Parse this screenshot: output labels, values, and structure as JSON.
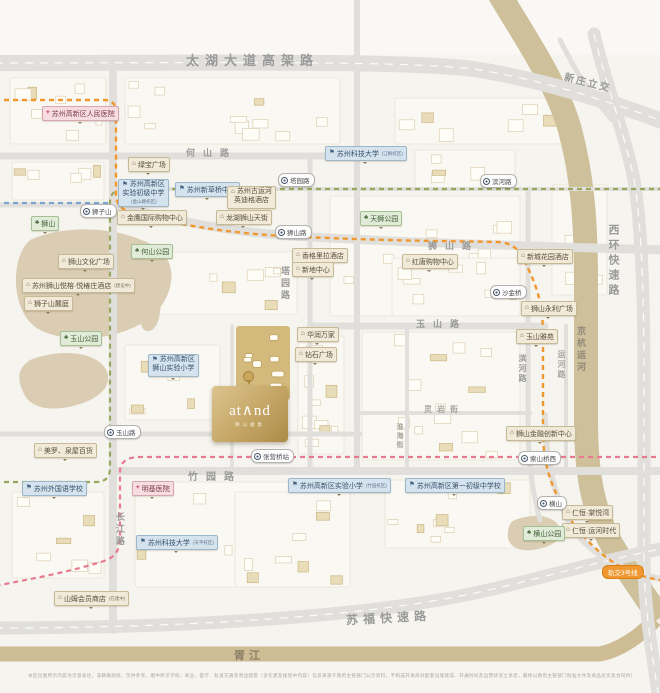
{
  "project": {
    "logo": "at∧nd",
    "subtitle": "狮山雅集"
  },
  "colors": {
    "gold": "#c9ab62",
    "canal": "#cfc09c",
    "metro_line_orange": "#f0982f",
    "metro_line_green": "#99a75d",
    "metro_line_pink": "#e8798f",
    "metro_line_blue": "#7ba3cf"
  },
  "icons": {
    "park": "♣",
    "hospital": "+",
    "school": "⚑",
    "shop": "⌂",
    "hotel": "⌂",
    "residence": "⌂"
  },
  "roads": {
    "taihu_viaduct": "太湖大道高架路",
    "xinzhuang": "新庄立交",
    "heshan": "何山路",
    "shishan": "狮山路",
    "yushan": "玉山路",
    "zhuyuan": "竹园路",
    "changjiang": "长江路",
    "tayuan": "塔园路",
    "huaihai": "淮海街",
    "binhe": "滨河路",
    "yunhe_rd": "运河路",
    "grand_canal": "京杭运河",
    "xihuan": "西环快速路",
    "sufu": "苏福快速路",
    "xujiang": "胥江",
    "lingyan": "灵岩街"
  },
  "stations": [
    "狮子山",
    "塔园路",
    "滨河路",
    "狮山路",
    "沙金桥",
    "玉山路",
    "张营桥站",
    "索山桥西",
    "横山"
  ],
  "metro_badge": "轨交3号线",
  "pois": [
    {
      "label": "苏州高新区人民医院",
      "type": "hospital"
    },
    {
      "label": "绿宝广场",
      "type": "shop"
    },
    {
      "label": "苏州高新区",
      "label2": "实验初级中学",
      "suffix": "(金山路校区)",
      "type": "school"
    },
    {
      "label": "苏州新草桥中学",
      "type": "school"
    },
    {
      "label": "苏州古运河",
      "label2": "英迪格酒店",
      "type": "hotel"
    },
    {
      "label": "苏州科技大学",
      "suffix": "(江枫校区)",
      "type": "school"
    },
    {
      "label": "金鹰国际购物中心",
      "type": "shop"
    },
    {
      "label": "龙湖狮山天街",
      "type": "shop"
    },
    {
      "label": "狮山",
      "type": "park"
    },
    {
      "label": "何山公园",
      "type": "park"
    },
    {
      "label": "天狮公园",
      "type": "park"
    },
    {
      "label": "狮山文化广场",
      "type": "shop"
    },
    {
      "label": "苏州狮山悦榕·悦椿庄酒店",
      "suffix": "(建设中)",
      "type": "hotel"
    },
    {
      "label": "狮子山麓庭",
      "type": "residence"
    },
    {
      "label": "红唐购物中心",
      "type": "shop"
    },
    {
      "label": "新城花园酒店",
      "type": "hotel"
    },
    {
      "label": "香格里拉酒店",
      "type": "hotel"
    },
    {
      "label": "新地中心",
      "type": "shop"
    },
    {
      "label": "狮山永利广场",
      "type": "shop"
    },
    {
      "label": "玉山雅苑",
      "type": "residence"
    },
    {
      "label": "华润万家",
      "type": "shop"
    },
    {
      "label": "钻石广场",
      "type": "shop"
    },
    {
      "label": "玉山公园",
      "type": "park"
    },
    {
      "label": "苏州高新区",
      "label2": "狮山实验小学",
      "type": "school"
    },
    {
      "label": "美罗、泉屋百货",
      "type": "shop"
    },
    {
      "label": "苏州外国语学校",
      "type": "school"
    },
    {
      "label": "明基医院",
      "type": "hospital"
    },
    {
      "label": "苏州科技大学",
      "suffix": "(天平校区)",
      "type": "school"
    },
    {
      "label": "山姆会员商店",
      "suffix": "(在建中)",
      "type": "shop"
    },
    {
      "label": "苏州高新区实验小学",
      "suffix": "(竹园校区)",
      "type": "school"
    },
    {
      "label": "苏州高新区第一初级中学校",
      "type": "school"
    },
    {
      "label": "狮山金融创新中心",
      "type": "shop"
    },
    {
      "label": "仁恒·棠悦湾",
      "type": "residence"
    },
    {
      "label": "仁恒·运河时代",
      "type": "residence"
    },
    {
      "label": "横山公园",
      "type": "park"
    }
  ],
  "disclaimer": "本区位图所示内容为示意表达，非精确测绘，仅供参考。图中所示学校、商业、医疗、轨道交通等周边配套（含在建及规划中内容）信息来源于政府主管部门公示资料，不构成开发商对配套设施建成、开通时间及运营状况之承诺，最终以政府主管部门批准文件及商品房买卖合同约定为准。本资料制作时间有限，敬请留意最新信息。详情请垂询销售现场。"
}
